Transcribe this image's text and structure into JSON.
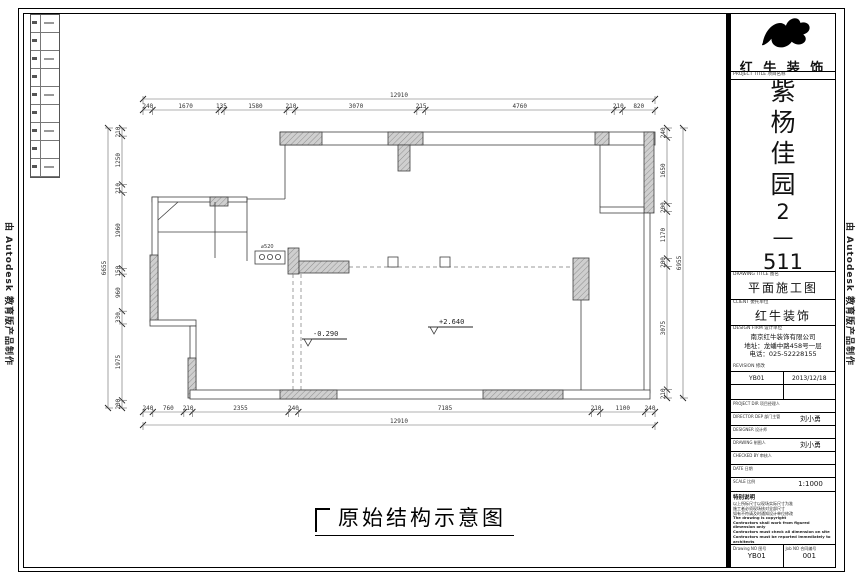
{
  "frame": {
    "autodesk_left": "由 Autodesk 教育版产品制作",
    "autodesk_right": "由 Autodesk 教育版产品制作"
  },
  "plan": {
    "caption": "原始结构示意图",
    "dims": {
      "top_total": "12910",
      "top_segments": [
        "240",
        "1670",
        "135",
        "1580",
        "210",
        "3070",
        "215",
        "4760",
        "210",
        "820"
      ],
      "bottom_total": "12910",
      "bottom_segments": [
        "240",
        "760",
        "210",
        "2355",
        "240",
        "7185",
        "210",
        "1100",
        "240"
      ],
      "left_total": "6655",
      "left_segments": [
        "210",
        "1250",
        "210",
        "1960",
        "150",
        "960",
        "330",
        "1975",
        "200"
      ],
      "right_total": "6955",
      "right_segments": [
        "240",
        "1650",
        "200",
        "1170",
        "200",
        "3075",
        "210"
      ]
    },
    "labels": {
      "level_low": "-0.290",
      "level_high": "+2.640",
      "flue": "⌀520"
    }
  },
  "titleblock": {
    "brand": "红 牛 装 饰",
    "project_label": "PROJECT TITLE 项目名称",
    "project_name_chars": [
      "紫",
      "杨",
      "佳",
      "园",
      "2",
      "—",
      "511"
    ],
    "drawing_title_label": "DRAWING TITLE 图名",
    "drawing_title": "平面施工图",
    "client_label": "CLIENT 委托单位",
    "client": "红牛装饰",
    "firm_label": "DESIGN FIRM 设计单位",
    "firm_lines": [
      "南京红牛装饰有限公司",
      "地址：龙蟠中路458号一层",
      "电话：025-52228155"
    ],
    "revision_label": "REVISION 修改",
    "revision_no": "YB01",
    "revision_date": "2013/12/18",
    "rows": [
      {
        "label": "PROJECT DIR 项目经理人",
        "value": ""
      },
      {
        "label": "DIRECTOR DEP 部门主管",
        "value": "刘小勇"
      },
      {
        "label": "DESIGNER 设计师",
        "value": ""
      },
      {
        "label": "DRAWING 制图人",
        "value": "刘小勇"
      },
      {
        "label": "CHECKED BY 审核人",
        "value": ""
      },
      {
        "label": "DATE 日期",
        "value": ""
      },
      {
        "label": "SCALE 比例",
        "value": "1:1000"
      }
    ],
    "notes_title": "特别说明",
    "notes_cn": [
      "以上所标尺寸以现场实际尺寸为准",
      "施工者必须现场核对全部尺寸",
      "如有不符请及时通知设计单位修改"
    ],
    "notes_en": [
      "The drawing is copyright",
      "Contractors shall work from figured dimension only",
      "Contractors must check all dimension on site",
      "Contractors must be reported immediately to architects"
    ],
    "drawing_no_label": "Drawing NO 图号",
    "drawing_no": "YB01",
    "job_no_label": "Job NO 合同编号",
    "job_no": "001"
  }
}
